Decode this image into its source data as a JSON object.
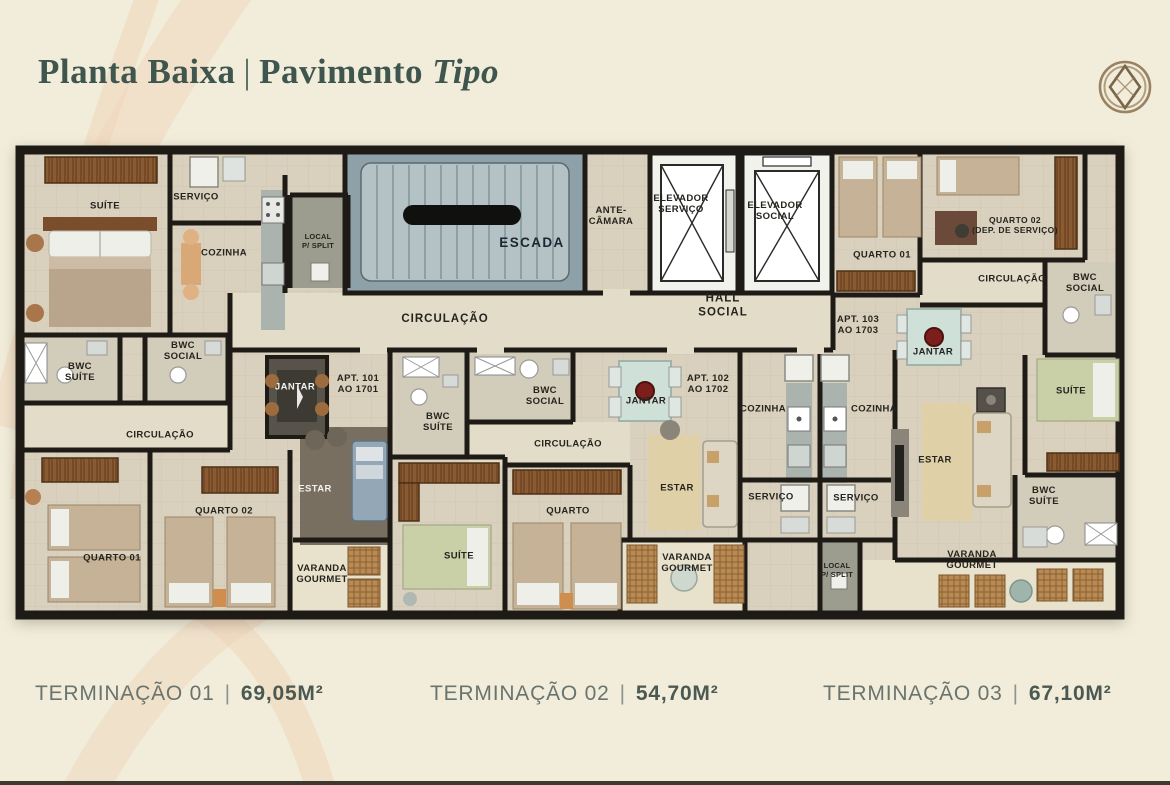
{
  "header": {
    "title": "Planta Baixa",
    "separator": "|",
    "subtitle": "Pavimento",
    "subtitle_italic": "Tipo"
  },
  "logo_icon": "orbital-diamond-emblem",
  "floor_plan": {
    "labels": [
      "SUÍTE",
      "SERVIÇO",
      "COZINHA",
      "LOCAL\nP/ SPLIT",
      "BWC\nSOCIAL",
      "BWC\nSUÍTE",
      "CIRCULAÇÃO",
      "JANTAR",
      "APT. 101\nAO 1701",
      "ESTAR",
      "QUARTO 02",
      "QUARTO 01",
      "VARANDA\nGOURMET",
      "ESCADA",
      "ANTE-\nCÂMARA",
      "CIRCULAÇÃO",
      "ELEVADOR\nSERVIÇO",
      "ELEVADOR\nSOCIAL",
      "HALL\nSOCIAL",
      "BWC\nSUÍTE",
      "BWC\nSOCIAL",
      "CIRCULAÇÃO",
      "JANTAR",
      "APT. 102\nAO 1702",
      "COZINHA",
      "SERVIÇO",
      "SUÍTE",
      "QUARTO",
      "ESTAR",
      "VARANDA\nGOURMET",
      "COZINHA",
      "SERVIÇO",
      "QUARTO 01",
      "QUARTO 02\n(DEP. DE SERVIÇO)",
      "CIRCULAÇÃO",
      "BWC\nSOCIAL",
      "APT. 103\nAO 1703",
      "JANTAR",
      "SUÍTE",
      "ESTAR",
      "BWC\nSUÍTE",
      "VARANDA\nGOURMET",
      "LOCAL\nP/ SPLIT"
    ]
  },
  "footer": {
    "separator": "|",
    "units": [
      {
        "name": "TERMINAÇÃO 01",
        "area": "69,05M²"
      },
      {
        "name": "TERMINAÇÃO 02",
        "area": "54,70M²"
      },
      {
        "name": "TERMINAÇÃO 03",
        "area": "67,10M²"
      }
    ]
  },
  "colors": {
    "background": "#f2edda",
    "swirl_accent": "#f0dcc3",
    "title_text": "#3e564d",
    "footer_text": "#6a746e",
    "footer_area_text": "#4b5952",
    "wall": "#1e1b17",
    "floor": "#d9d1bd",
    "stairs": "#8ea1a8",
    "dark_floor": "#786f60",
    "wood": "#8a5a33"
  }
}
